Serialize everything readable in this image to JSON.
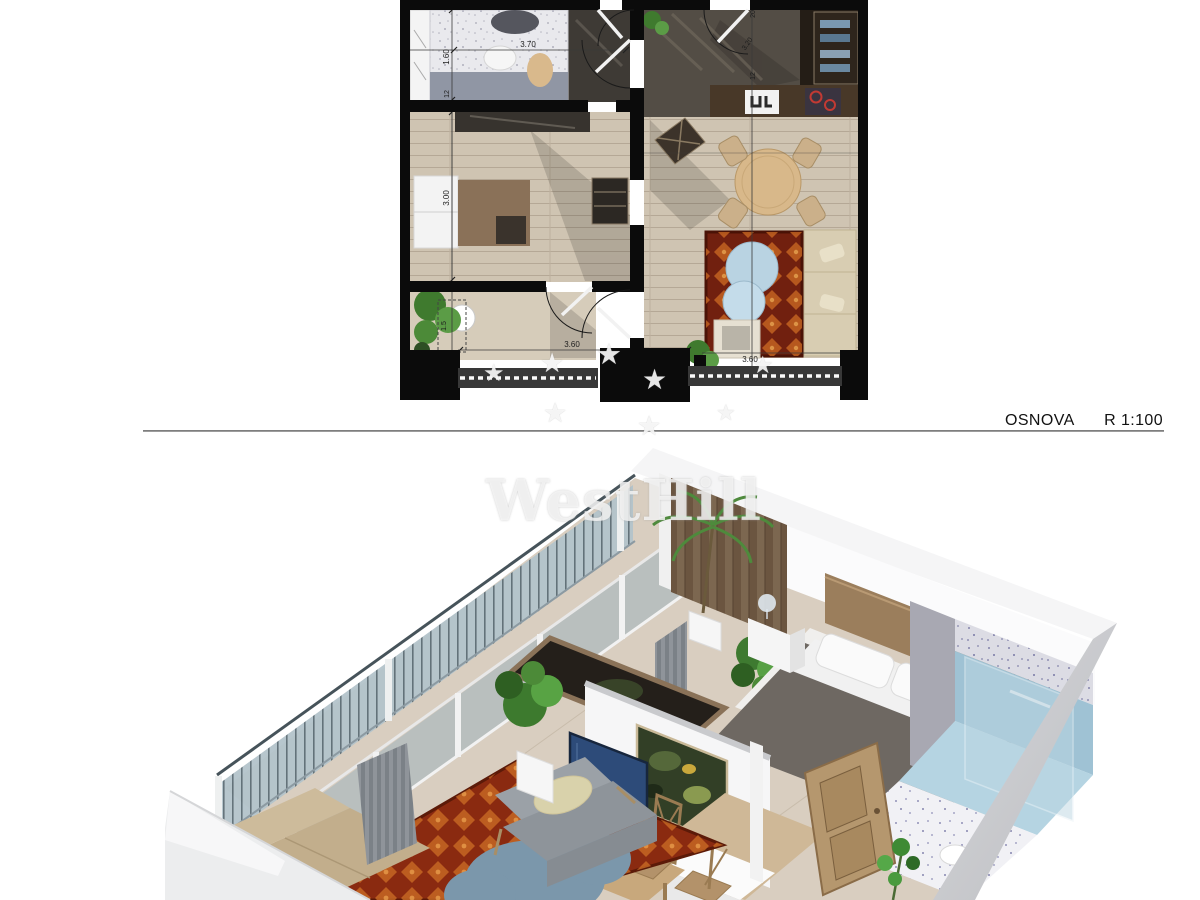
{
  "caption": {
    "title": "OSNOVA",
    "scale": "R 1:100"
  },
  "watermark": {
    "text": "WestHill",
    "star_glyph": "★"
  },
  "floor_plan": {
    "dims": {
      "d370": "3.70",
      "d160": "1.60",
      "d12a": "12",
      "d300": "3.00",
      "d15": "1.5",
      "d360a": "3.60",
      "d20": "20",
      "d320": "3.20",
      "d12b": "12",
      "d360b": "3.60"
    },
    "colors": {
      "wall": "#0b0b0b",
      "floor_light": "#cfc4b2",
      "floor_dark": "#534d45",
      "kitchen_counter": "#483828",
      "stove_ring": "#c23a33",
      "rug": "#71200f",
      "rug_accent": "#cc6a22",
      "coffee_table_blue": "#b9d3e2",
      "sofa_beige": "#d8cdb2",
      "plant_green": "#4e8a3c",
      "bed_blanket": "#9096a4",
      "railing_strip": "#383838"
    }
  },
  "render_3d": {
    "colors": {
      "wall_white": "#f5f5f6",
      "wall_shadow": "#c9cacd",
      "floor_wood": "#d9cec0",
      "wood_panel_wall": "#7c6750",
      "balcony_glass": "#b3c3ca",
      "curtain_gray": "#8f949a",
      "bed_blanket": "#6e6862",
      "headboard_wood": "#9b7e5c",
      "bathroom_tile": "#dcdce4",
      "shower_blue": "#9fc2d4",
      "rug_red": "#8a2a10",
      "rug_accent": "#cc6c24",
      "cloud_table_blue": "#7b97ab",
      "tv_screen_navy": "#2d4b79",
      "sideboard_wood": "#b89a72",
      "armchair_gray": "#9ba1a7",
      "sofa_beige": "#c2ae8c",
      "door_wood": "#b5976e",
      "painting_green": "#323f26",
      "plant_green": "#3d7a2e"
    }
  }
}
